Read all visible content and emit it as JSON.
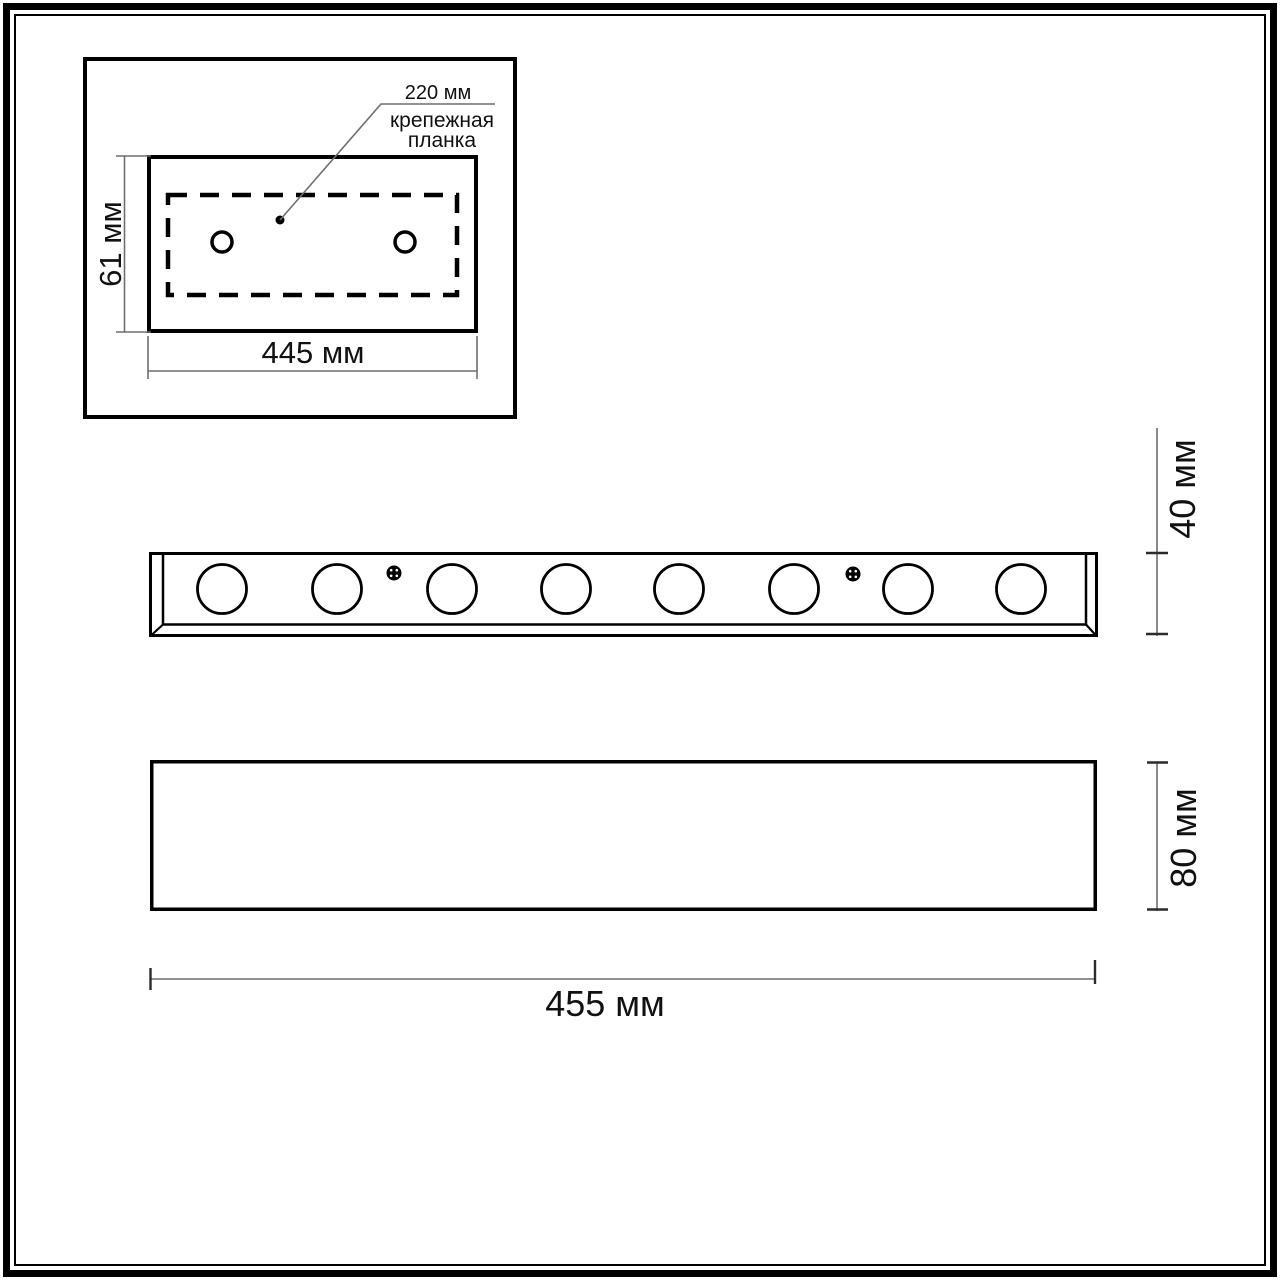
{
  "document_type": "technical dimension drawing of linear wall light",
  "colors": {
    "background": "#ffffff",
    "drawing_line": "#000000",
    "dimension_line": "#6e6e6e",
    "text": "#111111"
  },
  "inset_detail": {
    "bracket_offset_label": "220 мм",
    "bracket_name_line1": "крепежная",
    "bracket_name_line2": "планка",
    "plate_height_label": "61 мм",
    "plate_width_label": "445 мм",
    "mounting_hole_count": 2
  },
  "front_view": {
    "bar_height_label": "40 мм",
    "lamp_count": 8,
    "screw_count": 2
  },
  "side_profile": {
    "body_height_label": "80 мм",
    "body_width_label": "455 мм"
  }
}
